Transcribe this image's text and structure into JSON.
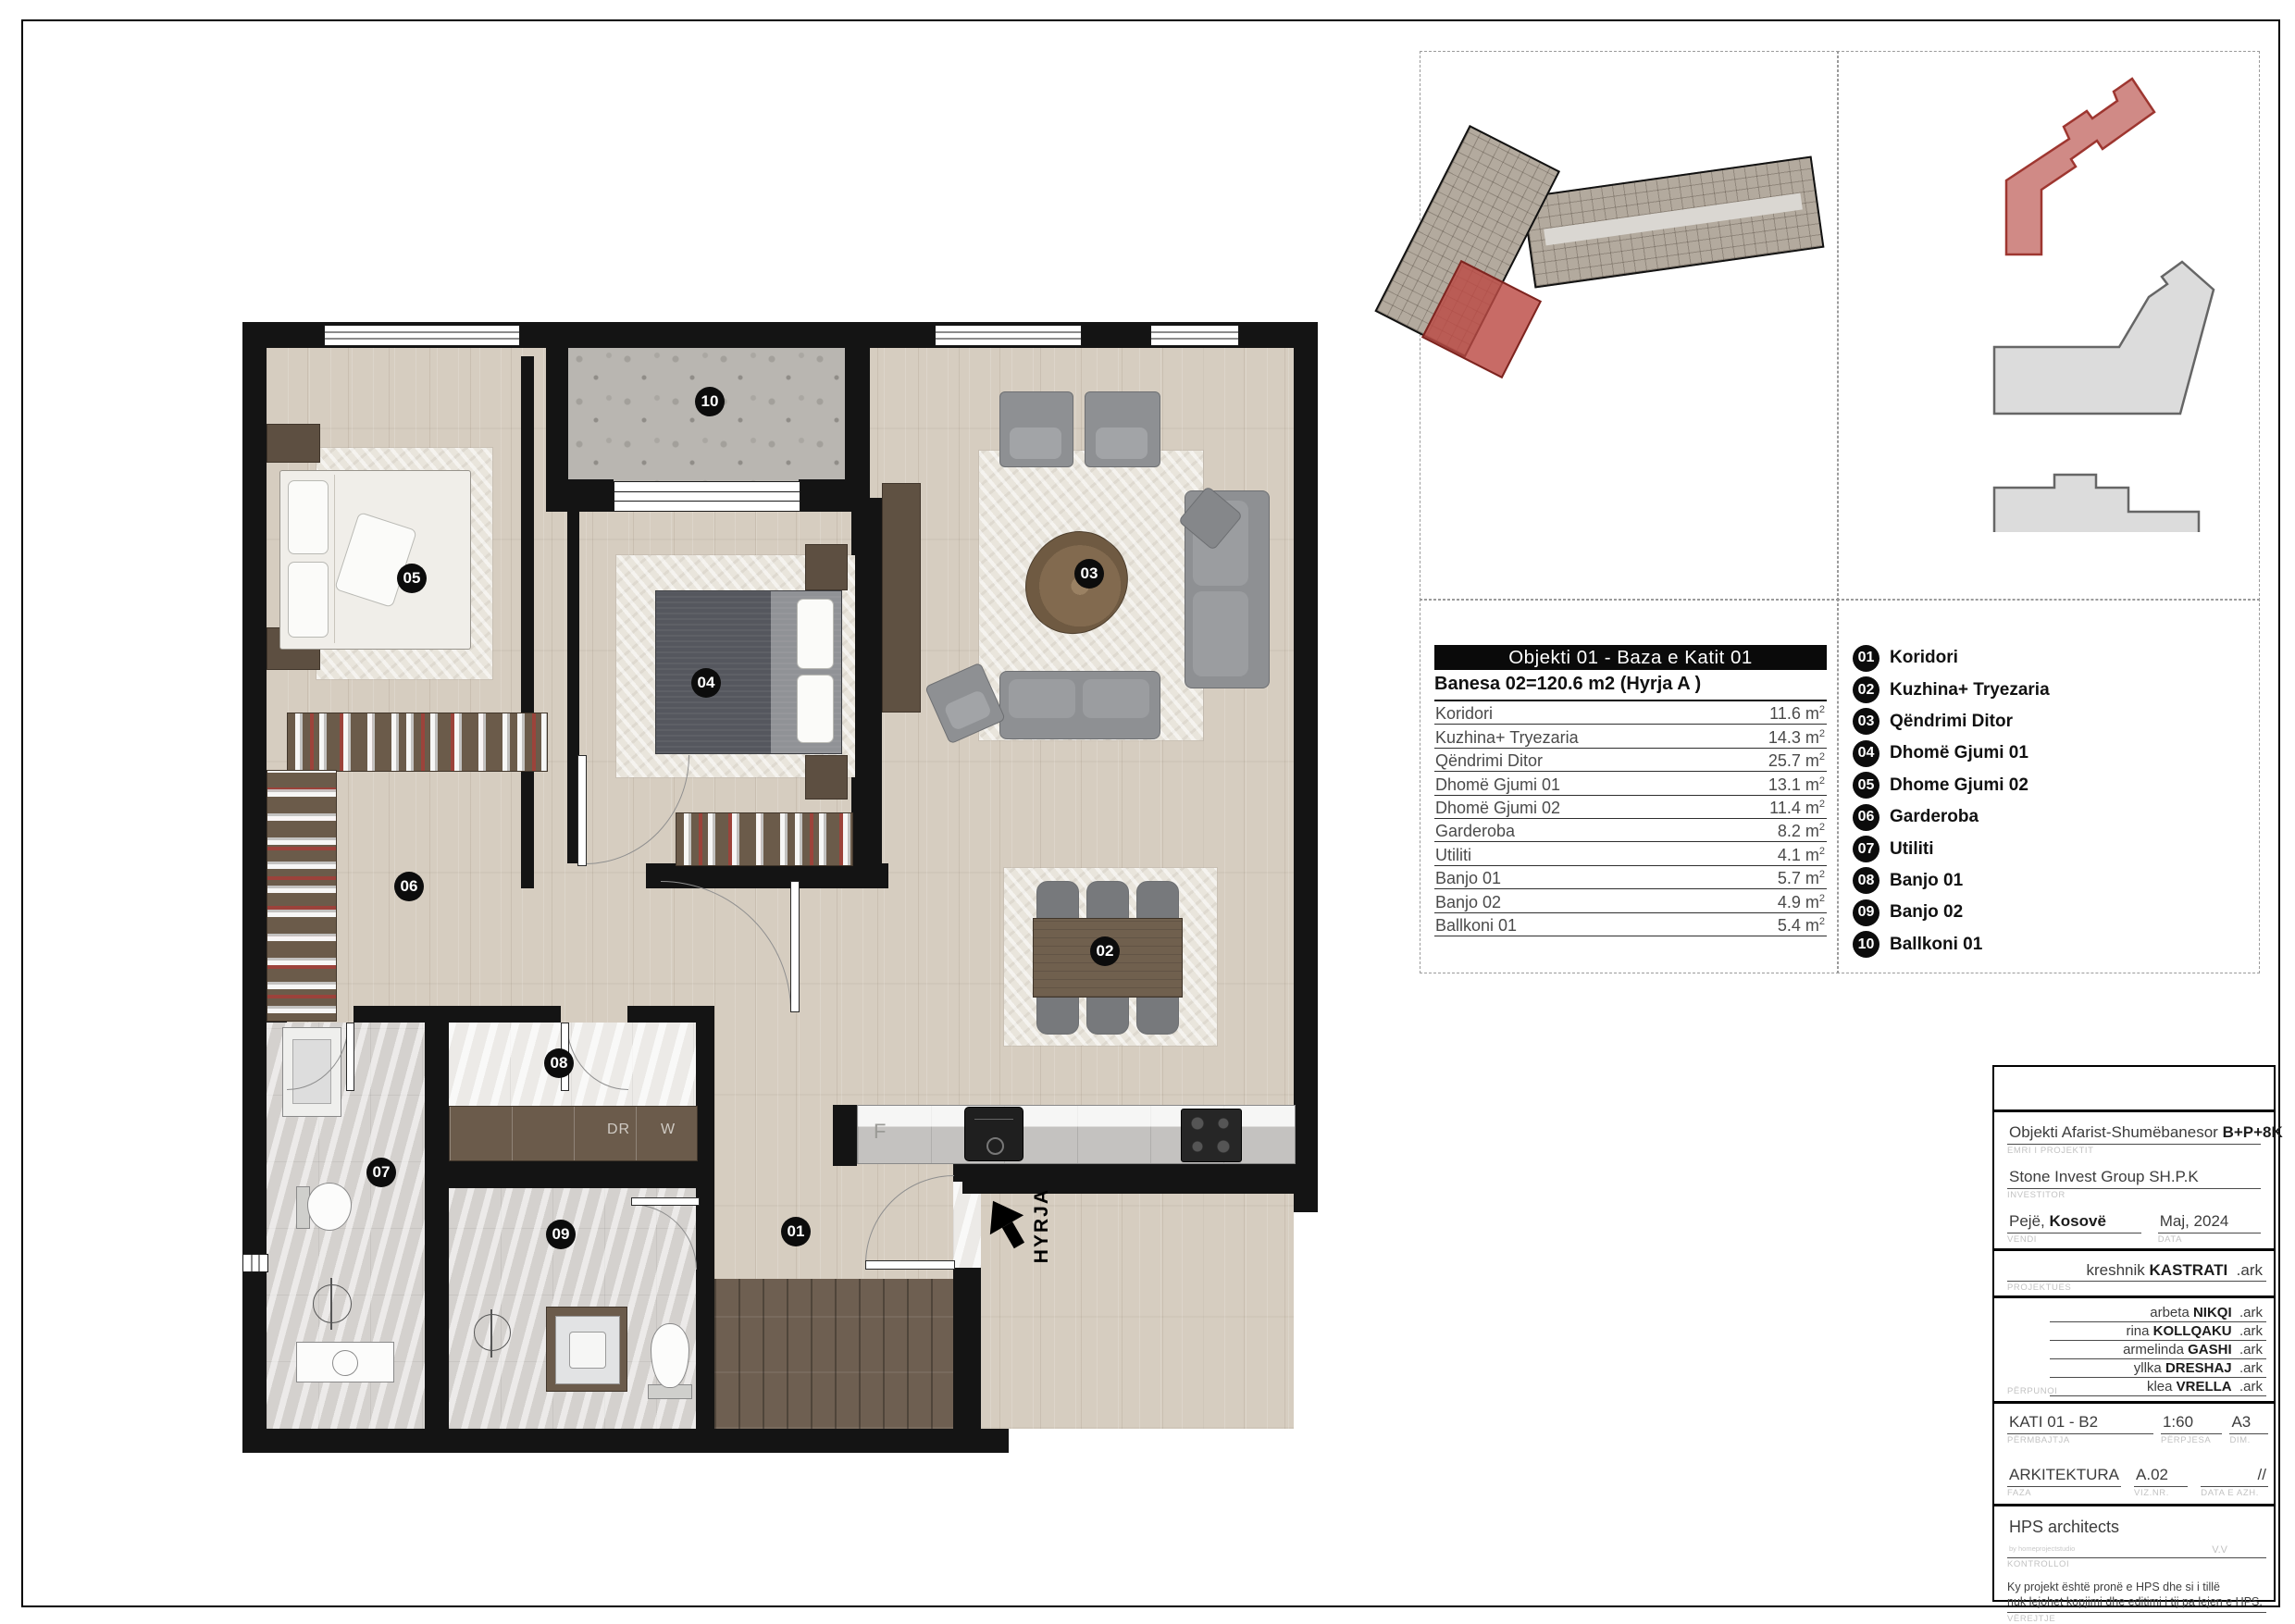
{
  "area_table": {
    "header": "Objekti 01 - Baza e Katit 01",
    "subtitle": "Banesa 02=120.6 m2 (Hyrja A )",
    "unit_base": "m",
    "unit_exp": "2",
    "rows": [
      {
        "name": "Koridori",
        "area": "11.6"
      },
      {
        "name": "Kuzhina+ Tryezaria",
        "area": "14.3"
      },
      {
        "name": "Qëndrimi Ditor",
        "area": "25.7"
      },
      {
        "name": "Dhomë Gjumi 01",
        "area": "13.1"
      },
      {
        "name": "Dhomë Gjumi 02",
        "area": "11.4"
      },
      {
        "name": "Garderoba",
        "area": "8.2"
      },
      {
        "name": "Utiliti",
        "area": "4.1"
      },
      {
        "name": "Banjo 01",
        "area": "5.7"
      },
      {
        "name": "Banjo 02",
        "area": "4.9"
      },
      {
        "name": "Ballkoni 01",
        "area": "5.4"
      }
    ]
  },
  "legend": {
    "items": [
      {
        "num": "01",
        "label": "Koridori"
      },
      {
        "num": "02",
        "label": "Kuzhina+ Tryezaria"
      },
      {
        "num": "03",
        "label": "Qëndrimi Ditor"
      },
      {
        "num": "04",
        "label": "Dhomë Gjumi 01"
      },
      {
        "num": "05",
        "label": "Dhome Gjumi 02"
      },
      {
        "num": "06",
        "label": "Garderoba"
      },
      {
        "num": "07",
        "label": "Utiliti"
      },
      {
        "num": "08",
        "label": "Banjo 01"
      },
      {
        "num": "09",
        "label": "Banjo 02"
      },
      {
        "num": "10",
        "label": "Ballkoni 01"
      }
    ]
  },
  "plan": {
    "badges": [
      "01",
      "02",
      "03",
      "04",
      "05",
      "06",
      "07",
      "08",
      "09",
      "10"
    ],
    "entrance_label": "HYRJA",
    "appliances": {
      "dryer": "DR",
      "washer": "W",
      "fridge": "F"
    }
  },
  "title_block": {
    "project": {
      "value": "Objekti Afarist-Shumëbanesor",
      "bold": "B+P+8K",
      "label": "EMRI I PROJEKTIT"
    },
    "investor": {
      "value": "Stone Invest Group SH.P.K",
      "label": "INVESTITOR"
    },
    "place": {
      "value": "Pejë,",
      "bold": "Kosovë",
      "label": "VENDI"
    },
    "date": {
      "value": "Maj, 2024",
      "label": "DATA"
    },
    "designer": {
      "first": "kreshnik",
      "last": "KASTRATI",
      "suffix": ".ark",
      "label": "PROJEKTUES"
    },
    "team": {
      "label": "PËRPUNOI",
      "suffix": ".ark",
      "members": [
        {
          "first": "arbeta",
          "last": "NIKQI"
        },
        {
          "first": "rina",
          "last": "KOLLQAKU"
        },
        {
          "first": "armelinda",
          "last": "GASHI"
        },
        {
          "first": "yllka",
          "last": "DRESHAJ"
        },
        {
          "first": "klea",
          "last": "VRELLA"
        }
      ]
    },
    "content": {
      "value": "KATI 01 - B2",
      "label": "PËRMBAJTJA"
    },
    "scale": {
      "value": "1:60",
      "label": "PËRPJESA"
    },
    "dim": {
      "value": "A3",
      "label": "DIM."
    },
    "phase": {
      "value": "ARKITEKTURA",
      "label": "FAZA"
    },
    "viz": {
      "value": "A.02",
      "label": "VIZ.NR."
    },
    "update": {
      "value": "//",
      "label": "DATA E AZH."
    },
    "control": {
      "value": "HPS architects",
      "sub": "by homeprojectstudio",
      "initials": "V.V",
      "label": "KONTROLLOI"
    },
    "note": {
      "line1": "Ky projekt është pronë e HPS dhe si i tillë",
      "line2": "nuk lejohet kopjimi dhe editimi i tij pa lejen e HPS.",
      "label": "VËREJTJE"
    }
  },
  "colors": {
    "accent_red": "#bc4a44",
    "wall": "#141414",
    "wood": "#d6cdc0",
    "highlight_fill": "#d08a86"
  }
}
